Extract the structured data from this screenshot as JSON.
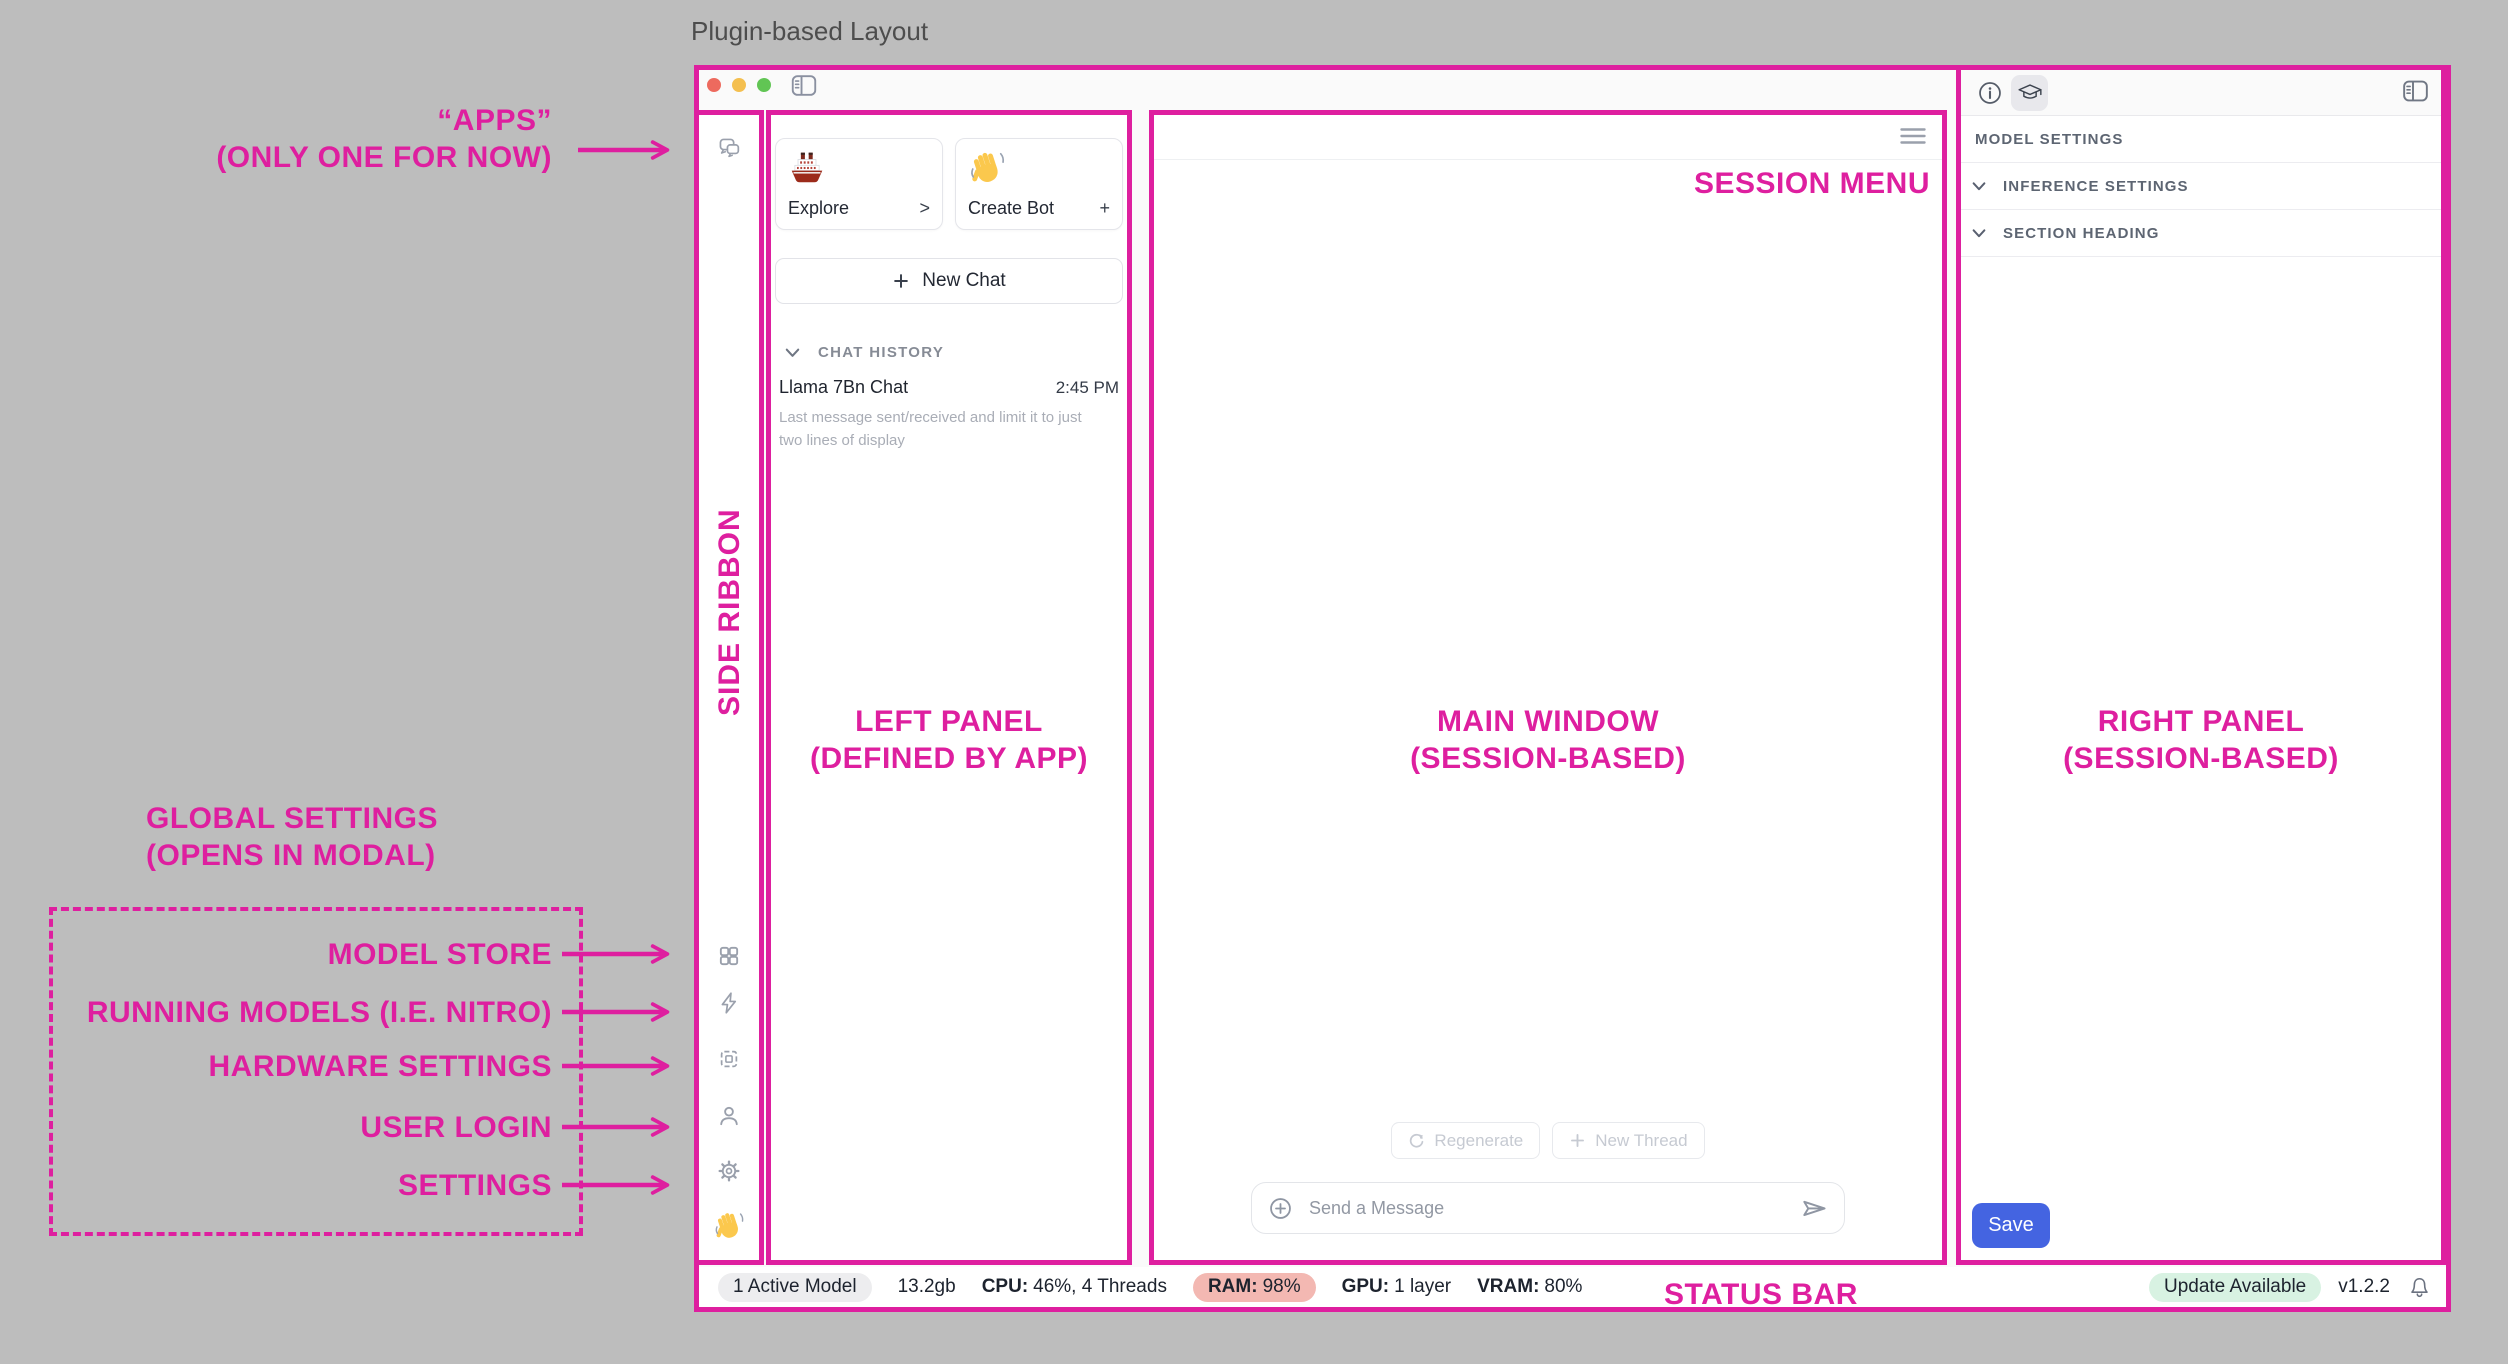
{
  "page": {
    "title": "Plugin-based Layout"
  },
  "win": {
    "titlebar": {
      "traffic_lights": [
        "close",
        "minimize",
        "zoom"
      ],
      "toggle_icon": "sidebar-toggle-icon"
    },
    "ribbon": {
      "icons": [
        "chat-icon",
        "apps-grid-icon",
        "lightning-icon",
        "chip-icon",
        "user-icon",
        "gear-icon",
        "wave-emoji"
      ]
    },
    "left": {
      "cards": [
        {
          "emoji": "ship-emoji",
          "label": "Explore",
          "action": ">"
        },
        {
          "emoji": "wave-emoji",
          "label": "Create Bot",
          "action": "+"
        }
      ],
      "new_chat": "New Chat",
      "history_heading": "CHAT HISTORY",
      "chat": {
        "title": "Llama 7Bn Chat",
        "time": "2:45 PM",
        "preview": "Last message sent/received and limit it to just two lines of display"
      }
    },
    "main": {
      "menu_icon": "hamburger-icon",
      "regenerate": "Regenerate",
      "new_thread": "New Thread",
      "composer_placeholder": "Send a Message"
    },
    "right": {
      "header_icons": [
        "info-icon",
        "graduation-cap-icon",
        "sidebar-toggle-icon"
      ],
      "rows": [
        {
          "label": "MODEL SETTINGS",
          "chevron": false
        },
        {
          "label": "INFERENCE SETTINGS",
          "chevron": true
        },
        {
          "label": "SECTION HEADING",
          "chevron": true
        }
      ],
      "save": "Save"
    },
    "status": {
      "active": "1 Active Model",
      "size": "13.2gb",
      "cpu": {
        "k": "CPU:",
        "v": "46%, 4 Threads"
      },
      "ram": {
        "k": "RAM:",
        "v": "98%"
      },
      "gpu": {
        "k": "GPU:",
        "v": "1 layer"
      },
      "vram": {
        "k": "VRAM:",
        "v": "80%"
      },
      "update": "Update Available",
      "version": "v1.2.2",
      "bell_icon": "bell-icon"
    }
  },
  "ann": {
    "apps1": "“APPS”",
    "apps2": "(ONLY ONE FOR NOW)",
    "side": "SIDE RIBBON",
    "left1": "LEFT PANEL",
    "left2": "(DEFINED BY APP)",
    "main1": "MAIN WINDOW",
    "main2": "(SESSION-BASED)",
    "right1": "RIGHT PANEL",
    "right2": "(SESSION-BASED)",
    "session": "SESSION MENU",
    "status": "STATUS BAR",
    "global1": "GLOBAL SETTINGS",
    "global2": "(OPENS IN MODAL)",
    "modal": [
      "MODEL STORE",
      "RUNNING MODELS (I.E. NITRO)",
      "HARDWARE SETTINGS",
      "USER LOGIN",
      "SETTINGS"
    ]
  },
  "colors": {
    "annotation_pink": "#de1f9f",
    "save_blue": "#4464e1",
    "ram_warning_bg": "#f3b8b2",
    "update_ok_bg": "#d8f2e2",
    "traffic_red": "#ed6a5e",
    "traffic_yellow": "#f4bf4f",
    "traffic_green": "#61c554"
  }
}
